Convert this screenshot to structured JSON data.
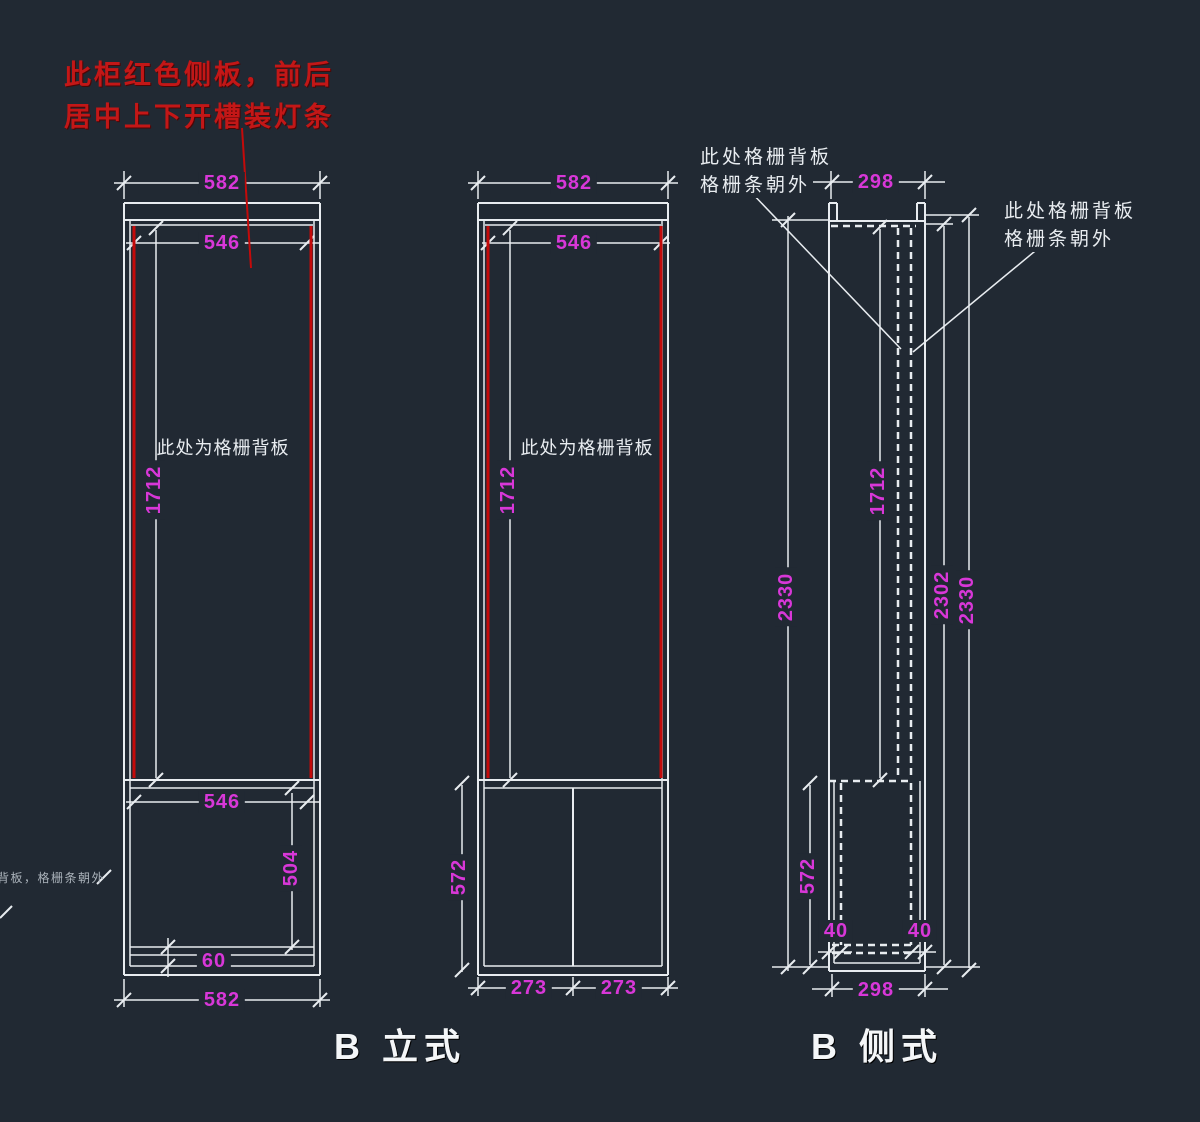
{
  "colors": {
    "background": "#212933",
    "line": "#e8ecf0",
    "dimension": "#d837d8",
    "red": "#c40a0a",
    "red_text": "#c31717"
  },
  "annotations": {
    "red_note_line1": "此柜红色侧板，前后",
    "red_note_line2": "居中上下开槽装灯条",
    "front1_grille_note": "此处为格栅背板",
    "front2_grille_note": "此处为格栅背板",
    "side_note_left_line1": "此处格栅背板",
    "side_note_left_line2": "格栅条朝外",
    "side_note_right_line1": "此处格栅背板",
    "side_note_right_line2": "格栅条朝外",
    "edge_note": "格栅背板，格栅条朝外"
  },
  "front_views": {
    "label": "B 立式",
    "view1": {
      "dims": {
        "top_width": "582",
        "inner_width": "546",
        "grille_height": "1712",
        "shelf_width": "546",
        "lower_height": "504",
        "base_height": "60",
        "bottom_width": "582"
      }
    },
    "view2": {
      "dims": {
        "top_width": "582",
        "inner_width": "546",
        "grille_height": "1712",
        "lower_height": "572",
        "door_left": "273",
        "door_right": "273"
      }
    }
  },
  "side_view": {
    "label": "B 侧式",
    "dims": {
      "top_depth": "298",
      "grille_height": "1712",
      "overall_left": "2330",
      "inner_height": "2302",
      "overall_right": "2330",
      "lower_height": "572",
      "back_gap_left": "40",
      "back_gap_right": "40",
      "bottom_depth": "298"
    }
  }
}
